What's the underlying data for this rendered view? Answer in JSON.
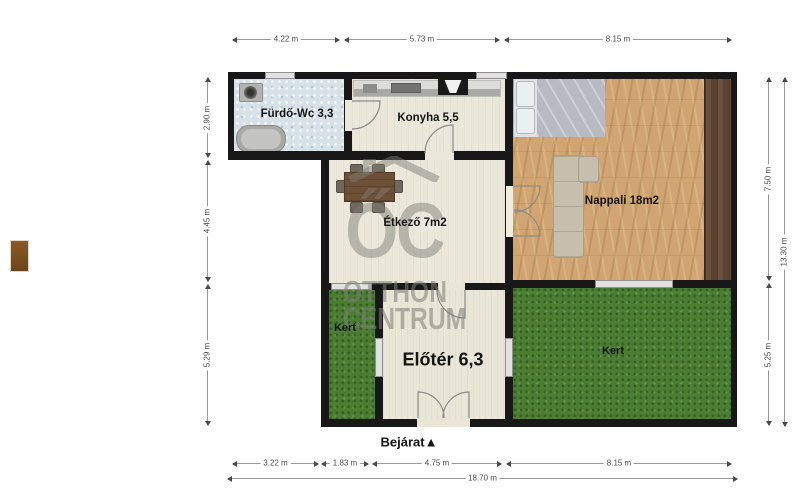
{
  "plan": {
    "rooms": {
      "bathroom": "Fürdő-Wc 3,3",
      "kitchen": "Konyha 5,5",
      "living_room": "Nappali 18m2",
      "dining": "Étkező 7m2",
      "hallway": "Előtér 6,3",
      "garden_left": "Kert",
      "garden_right": "Kert"
    },
    "entrance_label": "Bejárat▲"
  },
  "dimensions": {
    "top": [
      "4.22 m",
      "5.73 m",
      "8.15 m"
    ],
    "left": [
      "2.90 m",
      "4.45 m",
      "5.29 m"
    ],
    "right": [
      "7.50 m",
      "5.25 m"
    ],
    "right_total": "13.30 m",
    "bottom": [
      "3.22 m",
      "1.83 m",
      "4.75 m",
      "8.15 m"
    ],
    "bottom_total": "18.70 m"
  },
  "watermark": {
    "logo": "ŐC",
    "name_line1": "OTTHON",
    "name_line2": "CENTRUM"
  },
  "colors": {
    "wall": "#181818",
    "grass": "#4b7d33",
    "wood_floor": "#d0a571",
    "tile_floor": "#d6e2e8",
    "cream_floor": "#ebe8db",
    "watermark_gray": "#7d7d78"
  }
}
